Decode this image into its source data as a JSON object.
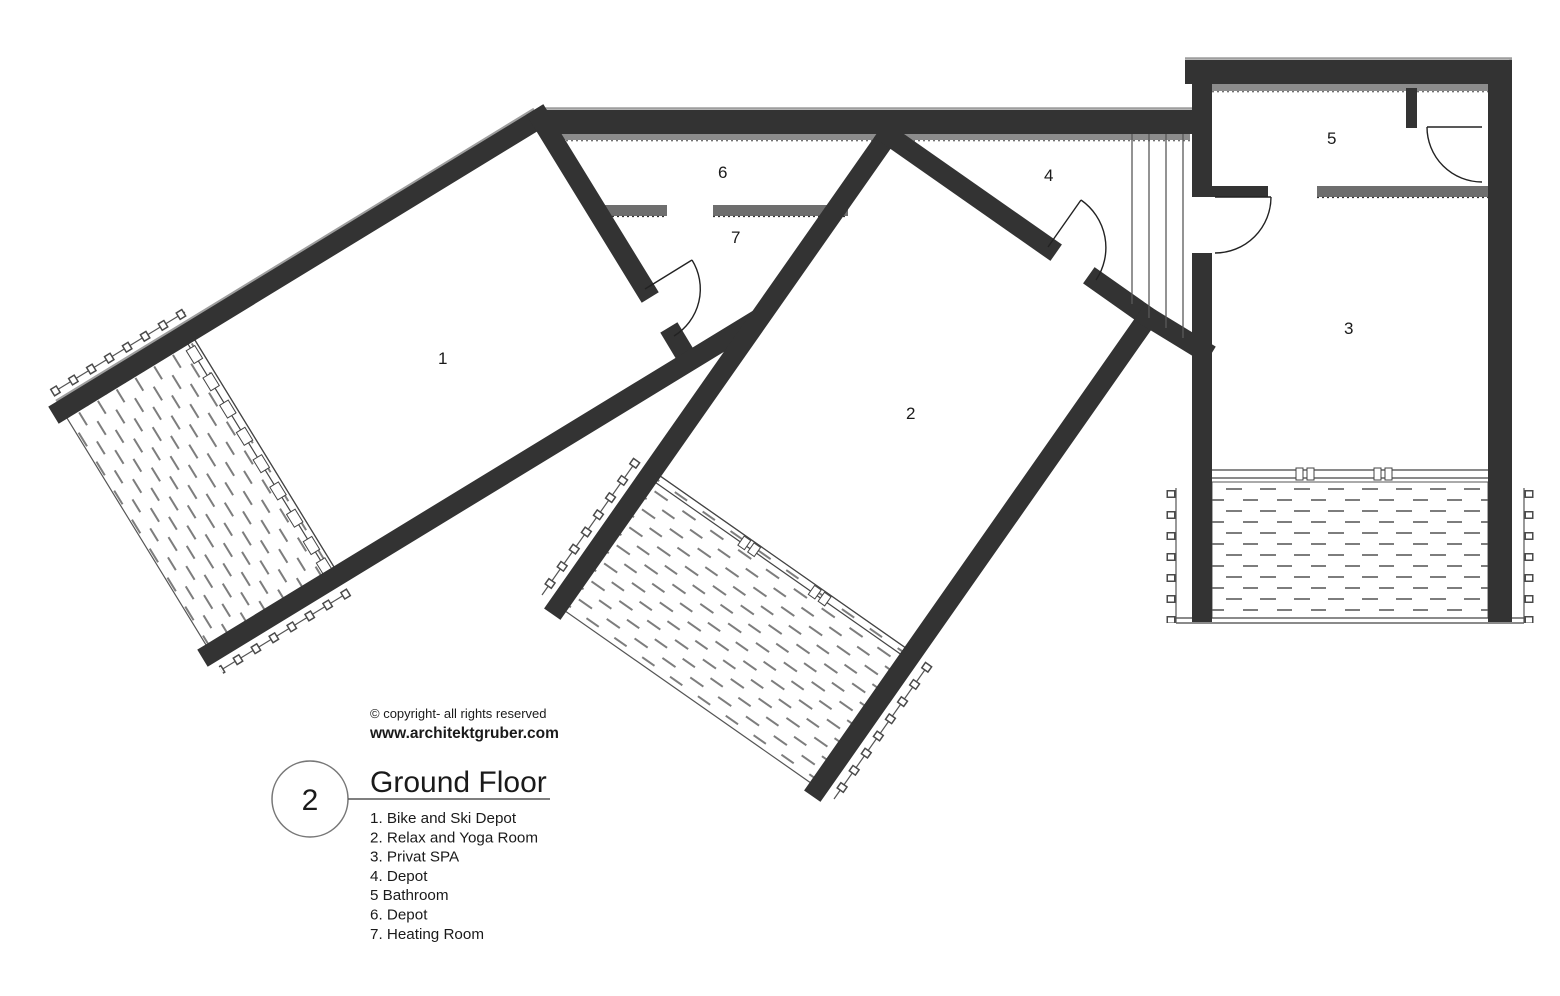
{
  "drawing": {
    "copyright_line": "© copyright- all rights reserved",
    "website": "www.architektgruber.com",
    "sheet_number": "2",
    "title": "Ground Floor",
    "legend_items": [
      "1. Bike and Ski Depot",
      "2. Relax and Yoga Room",
      "3. Privat SPA",
      "4. Depot",
      "5 Bathroom",
      "6. Depot",
      "7. Heating Room"
    ],
    "room_labels": [
      "1",
      "2",
      "3",
      "4",
      "5",
      "6",
      "7"
    ]
  },
  "colors": {
    "wall": "#333333",
    "half_wall": "#6e6e6e",
    "window_strip": "#8c8c8c",
    "hatch": "#7d7d7d",
    "background": "#ffffff"
  }
}
